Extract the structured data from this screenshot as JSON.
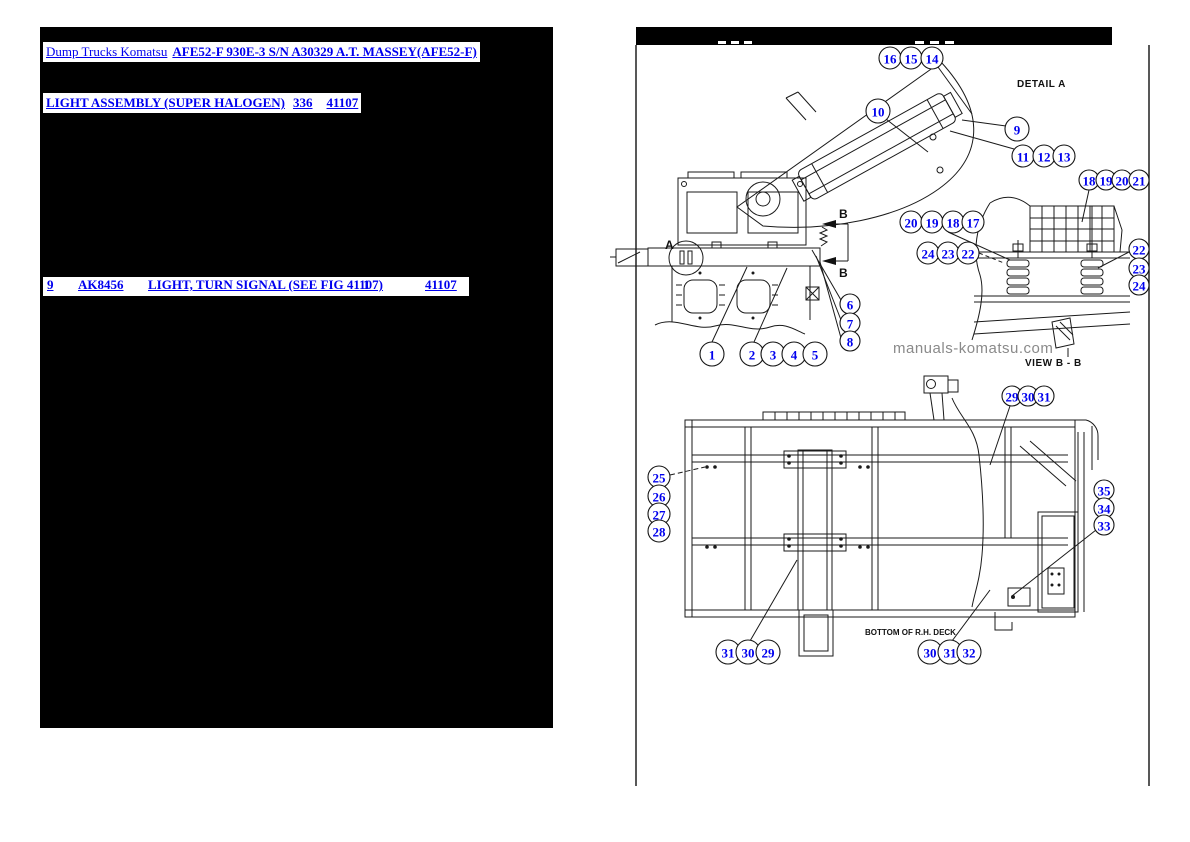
{
  "colors": {
    "link": "#0000ee",
    "panel_bg": "#000000",
    "line_art": "#1a1a1a",
    "watermark": "#8a8a8a"
  },
  "left_panel": {
    "breadcrumb": {
      "part1": "Dump Trucks Komatsu",
      "part2": "AFE52-F 930E-3 S/N A30329 A.T. MASSEY(AFE52-F)"
    },
    "section": {
      "title": "LIGHT ASSEMBLY (SUPER HALOGEN)",
      "page_no": "336",
      "fig_no": "41107"
    },
    "part_row": {
      "ref": "9",
      "part_no": "AK8456",
      "description": "LIGHT, TURN SIGNAL (SEE FIG 41107)",
      "qty": "1",
      "fig": "41107"
    }
  },
  "diagram": {
    "labels": {
      "detail_a": "DETAIL A",
      "view_bb": "VIEW B - B",
      "bottom_deck": "BOTTOM OF R.H. DECK",
      "watermark": "manuals-komatsu.com",
      "marker_a": "A",
      "marker_b_top": "B",
      "marker_b_bottom": "B"
    },
    "callouts": [
      {
        "n": "16",
        "x": 890,
        "y": 58,
        "r": 11
      },
      {
        "n": "15",
        "x": 911,
        "y": 58,
        "r": 11
      },
      {
        "n": "14",
        "x": 932,
        "y": 58,
        "r": 11
      },
      {
        "n": "10",
        "x": 878,
        "y": 111,
        "r": 12
      },
      {
        "n": "9",
        "x": 1017,
        "y": 129,
        "r": 12
      },
      {
        "n": "11",
        "x": 1023,
        "y": 156,
        "r": 11
      },
      {
        "n": "12",
        "x": 1044,
        "y": 156,
        "r": 11
      },
      {
        "n": "13",
        "x": 1064,
        "y": 156,
        "r": 11
      },
      {
        "n": "18",
        "x": 1089,
        "y": 180,
        "r": 10
      },
      {
        "n": "19",
        "x": 1106,
        "y": 180,
        "r": 10
      },
      {
        "n": "20",
        "x": 1122,
        "y": 180,
        "r": 10
      },
      {
        "n": "21",
        "x": 1139,
        "y": 180,
        "r": 10
      },
      {
        "n": "20",
        "x": 911,
        "y": 222,
        "r": 11
      },
      {
        "n": "19",
        "x": 932,
        "y": 222,
        "r": 11
      },
      {
        "n": "18",
        "x": 953,
        "y": 222,
        "r": 11
      },
      {
        "n": "17",
        "x": 973,
        "y": 222,
        "r": 11
      },
      {
        "n": "24",
        "x": 928,
        "y": 253,
        "r": 11
      },
      {
        "n": "23",
        "x": 948,
        "y": 253,
        "r": 11
      },
      {
        "n": "22",
        "x": 968,
        "y": 253,
        "r": 11
      },
      {
        "n": "22",
        "x": 1139,
        "y": 249,
        "r": 10
      },
      {
        "n": "23",
        "x": 1139,
        "y": 268,
        "r": 10
      },
      {
        "n": "24",
        "x": 1139,
        "y": 285,
        "r": 10
      },
      {
        "n": "6",
        "x": 850,
        "y": 304,
        "r": 10
      },
      {
        "n": "7",
        "x": 850,
        "y": 323,
        "r": 10
      },
      {
        "n": "8",
        "x": 850,
        "y": 341,
        "r": 10
      },
      {
        "n": "1",
        "x": 712,
        "y": 354,
        "r": 12
      },
      {
        "n": "2",
        "x": 752,
        "y": 354,
        "r": 12
      },
      {
        "n": "3",
        "x": 773,
        "y": 354,
        "r": 12
      },
      {
        "n": "4",
        "x": 794,
        "y": 354,
        "r": 12
      },
      {
        "n": "5",
        "x": 815,
        "y": 354,
        "r": 12
      },
      {
        "n": "25",
        "x": 659,
        "y": 477,
        "r": 11
      },
      {
        "n": "26",
        "x": 659,
        "y": 496,
        "r": 11
      },
      {
        "n": "27",
        "x": 659,
        "y": 514,
        "r": 11
      },
      {
        "n": "28",
        "x": 659,
        "y": 531,
        "r": 11
      },
      {
        "n": "29",
        "x": 1012,
        "y": 396,
        "r": 10
      },
      {
        "n": "30",
        "x": 1028,
        "y": 396,
        "r": 10
      },
      {
        "n": "31",
        "x": 1044,
        "y": 396,
        "r": 10
      },
      {
        "n": "35",
        "x": 1104,
        "y": 490,
        "r": 10
      },
      {
        "n": "34",
        "x": 1104,
        "y": 508,
        "r": 10
      },
      {
        "n": "33",
        "x": 1104,
        "y": 525,
        "r": 10
      },
      {
        "n": "31",
        "x": 728,
        "y": 652,
        "r": 12
      },
      {
        "n": "30",
        "x": 748,
        "y": 652,
        "r": 12
      },
      {
        "n": "29",
        "x": 768,
        "y": 652,
        "r": 12
      },
      {
        "n": "30",
        "x": 930,
        "y": 652,
        "r": 12
      },
      {
        "n": "31",
        "x": 950,
        "y": 652,
        "r": 12
      },
      {
        "n": "32",
        "x": 969,
        "y": 652,
        "r": 12
      }
    ]
  }
}
